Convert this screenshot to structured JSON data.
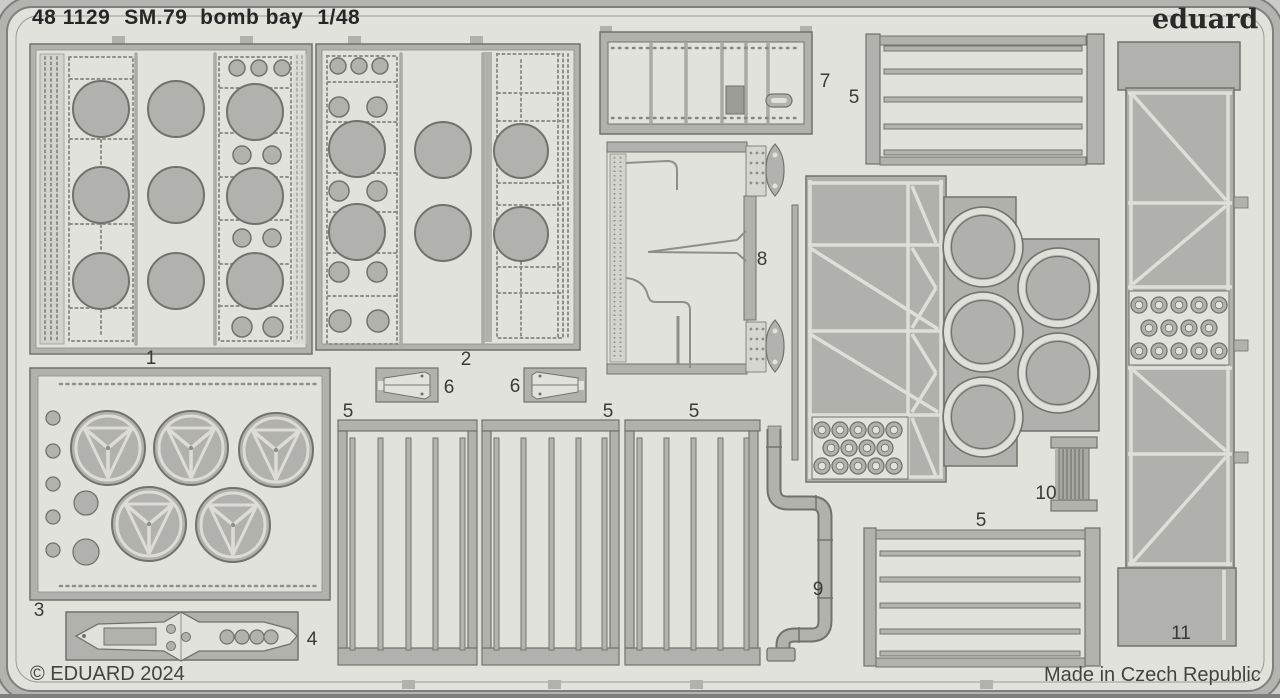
{
  "header": {
    "catalog_number": "48 1129",
    "product_name": "SM.79  bomb bay",
    "scale": "1/48"
  },
  "brand": {
    "logo_text": "eduard"
  },
  "footer": {
    "copyright": "© EDUARD 2024",
    "origin": "Made in Czech Republic"
  },
  "colors": {
    "outer_background": "#cbcbc7",
    "sheet_background": "#e2e2dc",
    "metal": "#b1b1ad",
    "outline": "#72726d",
    "half_etch": "#d3d3cd"
  },
  "part_labels": [
    {
      "part": "1"
    },
    {
      "part": "2"
    },
    {
      "part": "3"
    },
    {
      "part": "4"
    },
    {
      "part": "5"
    },
    {
      "part": "5"
    },
    {
      "part": "5"
    },
    {
      "part": "5"
    },
    {
      "part": "5"
    },
    {
      "part": "6"
    },
    {
      "part": "6"
    },
    {
      "part": "7"
    },
    {
      "part": "8"
    },
    {
      "part": "9"
    },
    {
      "part": "10"
    },
    {
      "part": "11"
    }
  ]
}
